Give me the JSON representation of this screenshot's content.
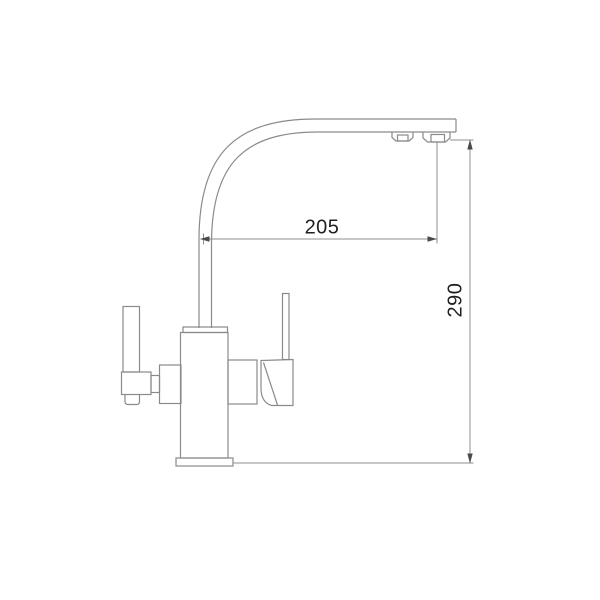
{
  "drawing": {
    "type": "technical-line-drawing",
    "subject": "kitchen faucet side view with outline dimensions",
    "line_color": "#8a8a8a",
    "dimension_text_color": "#1f1f1f",
    "background_color": "#ffffff",
    "dimensions": {
      "horizontal": {
        "value": "205"
      },
      "vertical": {
        "value": "290"
      }
    },
    "parts": [
      "curved-spout",
      "spout-aerator-front",
      "spout-aerator-main",
      "riser-pipe",
      "body-collar",
      "faucet-body",
      "body-right-arm",
      "right-handle-body",
      "right-handle-lever",
      "left-mounting-block",
      "left-handle-connector",
      "left-handle-block",
      "left-handle-lever",
      "left-handle-foot",
      "base-flange"
    ]
  }
}
